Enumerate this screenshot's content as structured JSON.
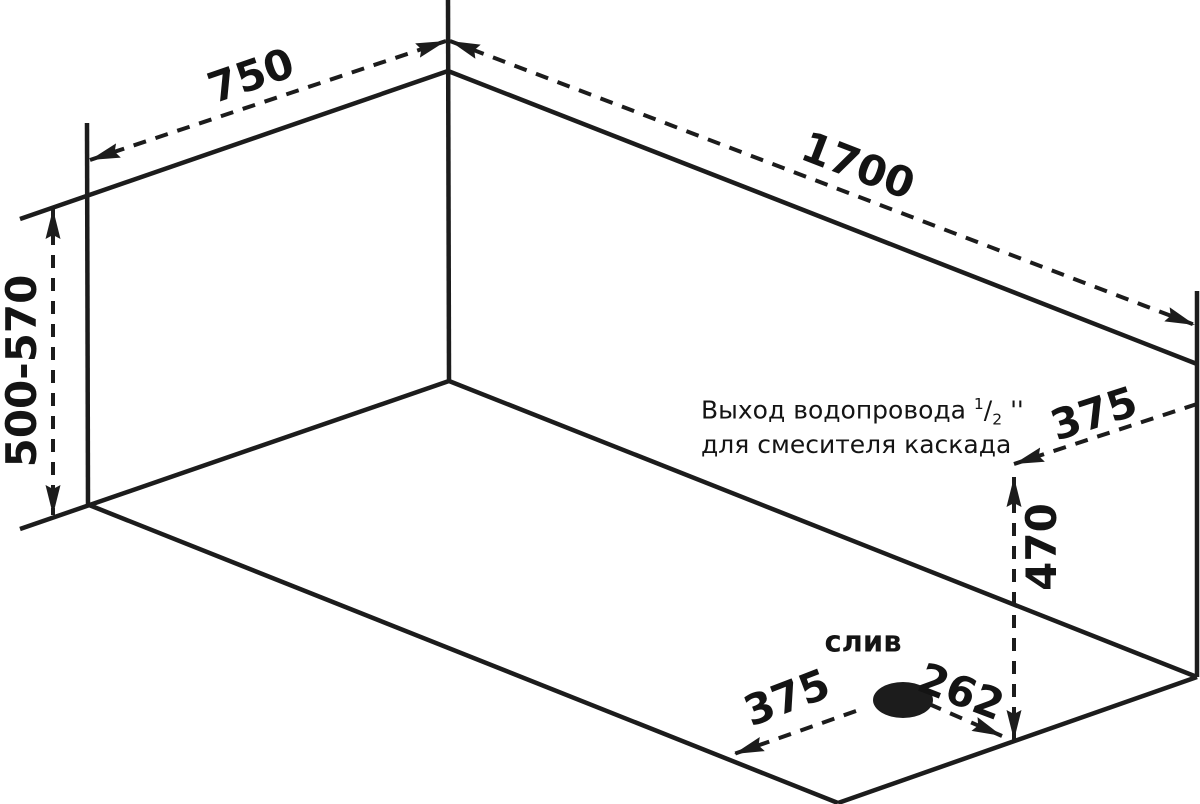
{
  "labels": {
    "width_750": "750",
    "length_1700": "1700",
    "height_range": "500-570",
    "outlet_offset_375": "375",
    "outlet_height_470": "470",
    "drain_caption": "слив",
    "drain_offset_375": "375",
    "drain_offset_262": "262"
  },
  "annotation": {
    "line1_text": "Выход водопровода ",
    "fraction_sup": "1",
    "fraction_slash": "/",
    "fraction_sub": "2",
    "inch_marks": "''",
    "line2_text": "для смесителя каскада"
  },
  "colors": {
    "line": "#1c1c1c",
    "text": "#141414",
    "background": "#ffffff"
  }
}
